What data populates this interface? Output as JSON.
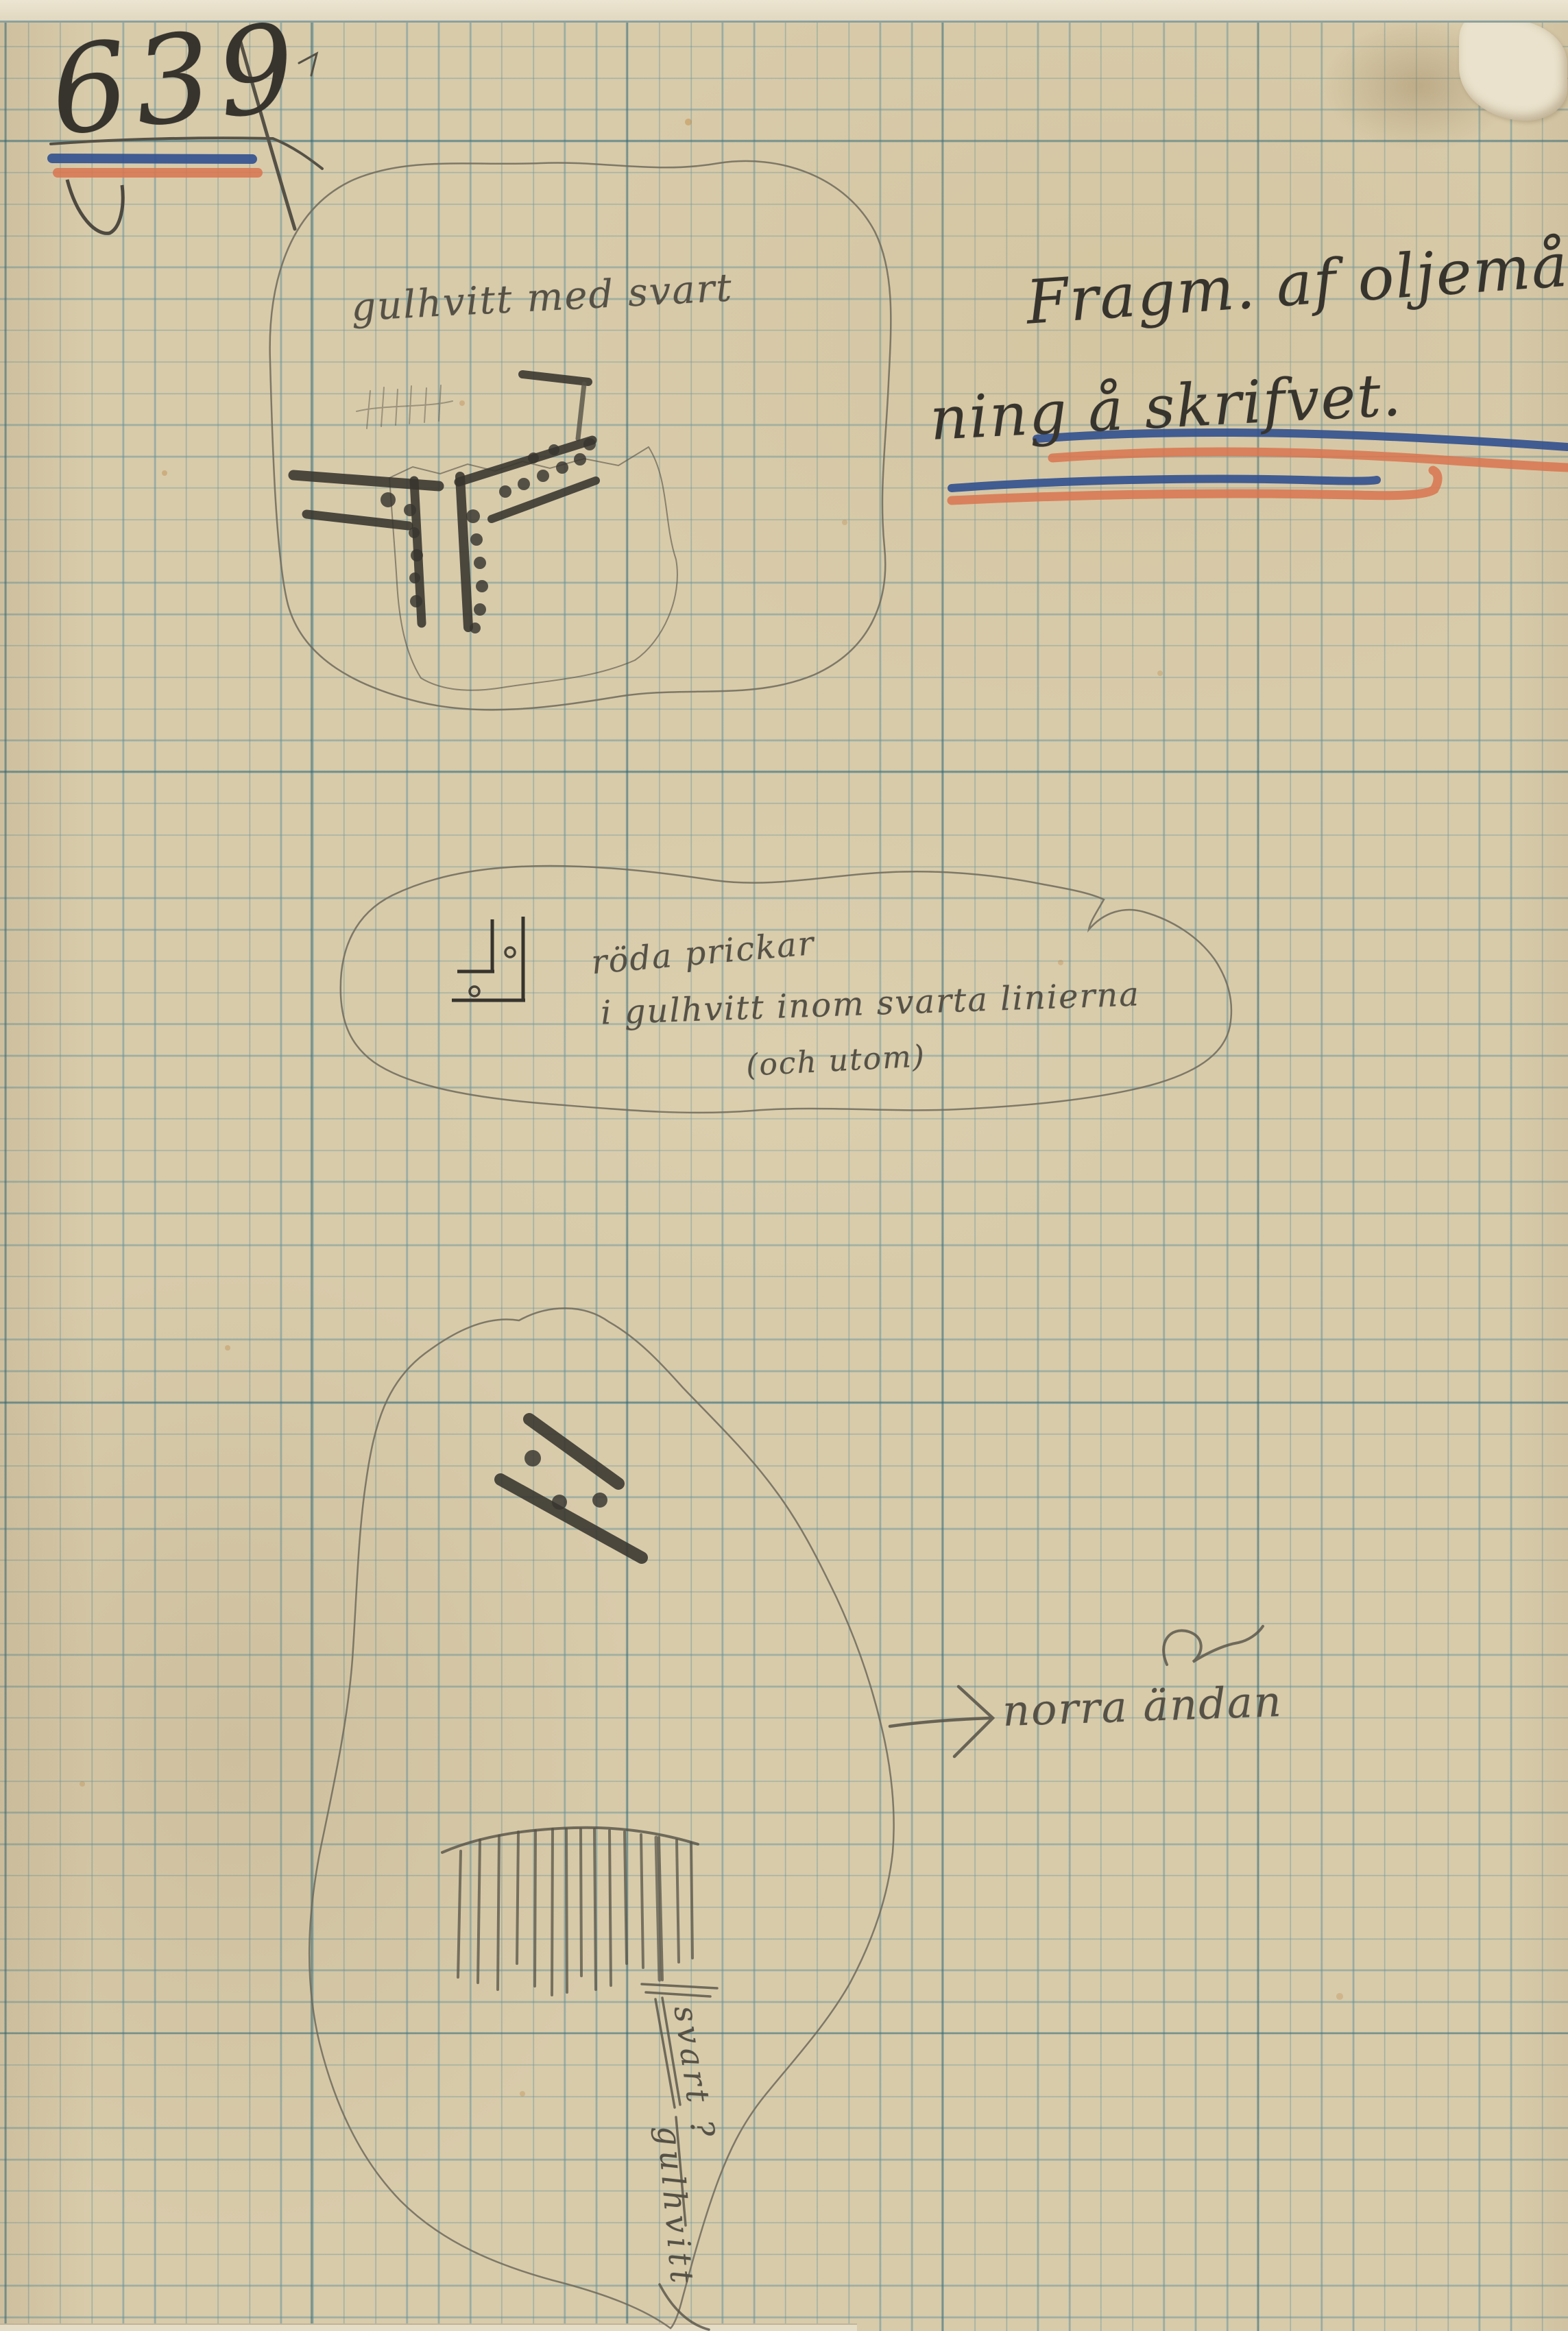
{
  "catalog_number": "639",
  "heading": {
    "line1": "Fragm. af oljemål-",
    "line2": "ning å skrifvet."
  },
  "fragments": [
    {
      "id": "fragment-1",
      "label": "gulhvitt med svart"
    },
    {
      "id": "fragment-2",
      "notes": [
        "röda prickar",
        "i gulhvitt inom svarta linierna",
        "(och utom)"
      ]
    },
    {
      "id": "fragment-3",
      "arrow_note": "norra ändan",
      "vertical_note_upper": "svart ?",
      "vertical_note_lower": "gulhvitt"
    }
  ],
  "colors": {
    "paper": "#d8cbaa",
    "grid": "#649199",
    "grid-bold": "#28606e",
    "pencil-dark": "#37342e",
    "pencil-mid": "#555146",
    "pencil-light": "#6f6a5c",
    "ink-blue": "#31508f",
    "ink-red": "#d9744f"
  }
}
